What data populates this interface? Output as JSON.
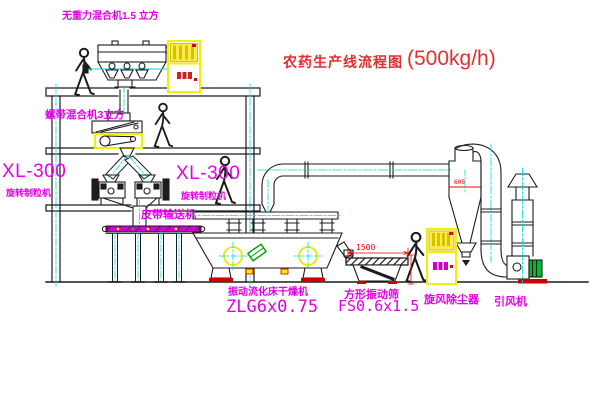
{
  "diagram": {
    "title": {
      "main": "农药生产线流程图",
      "capacity": "(500kg/h)"
    },
    "labels": {
      "mixer_top": "无重力混合机1.5 立方",
      "mixer_2f": "螺带混合机3立方",
      "model_left": "XL-300",
      "granulator_left": "旋转制粒机",
      "model_mid": "XL-300",
      "granulator_mid": "旋转制粒机",
      "belt_conveyor": "皮带输送机",
      "dryer_name": "振动流化床干燥机",
      "dryer_model": "ZLG6x0.75",
      "screen_name": "方形振动筛",
      "screen_model": "FS0.6x1.5",
      "cyclone": "旋风除尘器",
      "fan": "引风机"
    },
    "dimensions": {
      "screen_length": "1500",
      "cyclone_body": "600"
    },
    "colors": {
      "label_magenta": "#E400E4",
      "title_red": "#E03030",
      "dimension_red": "#EE0000",
      "centerline_cyan": "#00DDDD",
      "highlight_yellow": "#F0F000",
      "machine_green": "#00B300",
      "base_red": "#CC0000",
      "line_black": "#1C1C1C"
    }
  }
}
